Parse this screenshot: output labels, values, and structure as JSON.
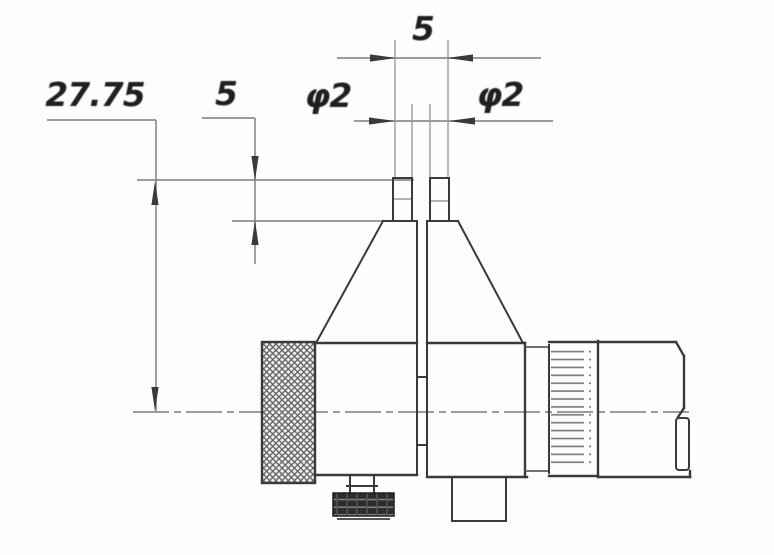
{
  "figure": {
    "labels": {
      "dim_height_to_centerline": "27.75",
      "dim_tip_length": "5",
      "dim_tip_span": "5",
      "dim_tip_diameter_left": "φ2",
      "dim_tip_diameter_right": "φ2"
    },
    "colors": {
      "background": "#fdfdfd",
      "line_dark": "#3a3a3a",
      "line_gray": "#8e8e8e",
      "text": "#1f1f1f"
    }
  }
}
